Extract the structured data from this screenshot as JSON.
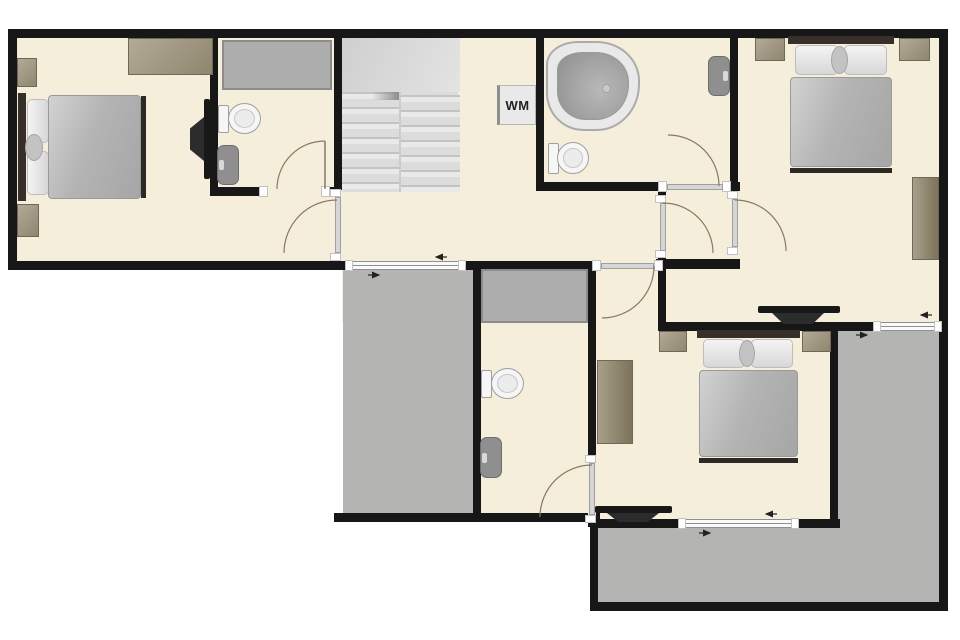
{
  "labels": {
    "washing_machine": "WM"
  },
  "palette": {
    "wall": "#171717",
    "floor": "#f5eedb",
    "terrace": "#b4b4b2",
    "stairs": "#dcdcdc",
    "shower": "#adadad",
    "wood": "#a09780",
    "bed_blanket": "#b5b5b5",
    "fixture_white": "#f4f4f4",
    "door_arc": "#8a7963"
  },
  "rooms": [
    {
      "name": "bedroom-top-left",
      "items": [
        "double bed",
        "nightstand",
        "nightstand",
        "dresser",
        "wall tv"
      ]
    },
    {
      "name": "ensuite-bathroom-top-left",
      "items": [
        "shower",
        "toilet",
        "washbasin"
      ]
    },
    {
      "name": "staircase",
      "items": [
        "double-flight stairs"
      ]
    },
    {
      "name": "hallway",
      "items": [
        "washing machine",
        "window"
      ]
    },
    {
      "name": "bathroom-center",
      "items": [
        "corner bathtub",
        "toilet",
        "washbasin"
      ]
    },
    {
      "name": "vestibule",
      "items": [
        "door to hallway",
        "door to bathroom",
        "door to bedroom"
      ]
    },
    {
      "name": "bedroom-top-right",
      "items": [
        "double bed",
        "nightstand",
        "nightstand",
        "desk",
        "wall tv",
        "window"
      ]
    },
    {
      "name": "bedroom-bottom",
      "items": [
        "double bed",
        "nightstand",
        "nightstand",
        "desk",
        "wall tv",
        "window"
      ]
    },
    {
      "name": "ensuite-bathroom-bottom",
      "items": [
        "shower",
        "toilet",
        "washbasin"
      ]
    },
    {
      "name": "terrace-center",
      "items": []
    },
    {
      "name": "terrace-right",
      "items": []
    }
  ]
}
